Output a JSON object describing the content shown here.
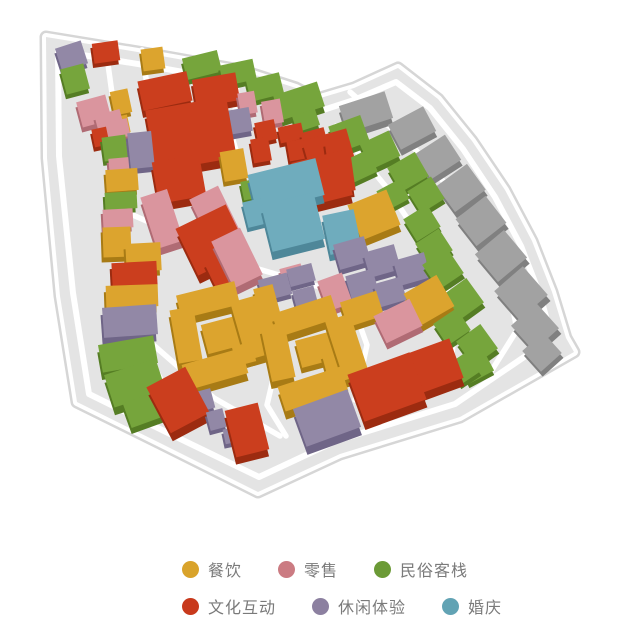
{
  "page": {
    "background": "#FFFFFF"
  },
  "categories": {
    "d": {
      "id": "dining",
      "label": "餐饮",
      "dot": "#D9A32B",
      "top": "#DCA42E",
      "side": "#A87B15"
    },
    "r": {
      "id": "retail",
      "label": "零售",
      "dot": "#CB7B82",
      "top": "#DA959E",
      "side": "#B06B74"
    },
    "i": {
      "id": "folk-inn",
      "label": "民俗客栈",
      "dot": "#6B9A36",
      "top": "#76A53C",
      "side": "#557D24"
    },
    "c": {
      "id": "culture",
      "label": "文化互动",
      "dot": "#C8391C",
      "top": "#CB3E1E",
      "side": "#9C2B10"
    },
    "l": {
      "id": "leisure",
      "label": "休闲体验",
      "dot": "#8C80A0",
      "top": "#9288A6",
      "side": "#6F6587"
    },
    "w": {
      "id": "wedding",
      "label": "婚庆",
      "dot": "#62A3B4",
      "top": "#6FACBD",
      "side": "#4E8799"
    },
    "g": {
      "id": "uncategorized",
      "label": "",
      "dot": "",
      "top": "#A2A2A2",
      "side": "#808080"
    }
  },
  "legend": {
    "text_color": "#7A7A7A",
    "rows": [
      {
        "items": [
          {
            "cat": "d",
            "label": "餐饮"
          },
          {
            "cat": "r",
            "label": "零售"
          },
          {
            "cat": "i",
            "label": "民俗客栈"
          }
        ]
      },
      {
        "items": [
          {
            "cat": "c",
            "label": "文化互动"
          },
          {
            "cat": "l",
            "label": "休闲体验"
          },
          {
            "cat": "w",
            "label": "婚庆"
          }
        ]
      }
    ]
  },
  "map": {
    "ground_color": "#E4E4E4",
    "border_color": "#D6D6D6",
    "road_color": "#FFFFFF",
    "outline": [
      [
        46,
        37
      ],
      [
        150,
        54
      ],
      [
        240,
        70
      ],
      [
        296,
        88
      ],
      [
        317,
        99
      ],
      [
        354,
        88
      ],
      [
        398,
        68
      ],
      [
        438,
        99
      ],
      [
        472,
        141
      ],
      [
        505,
        190
      ],
      [
        532,
        241
      ],
      [
        552,
        292
      ],
      [
        566,
        338
      ],
      [
        574,
        352
      ],
      [
        460,
        417
      ],
      [
        340,
        454
      ],
      [
        258,
        492
      ],
      [
        160,
        443
      ],
      [
        77,
        402
      ],
      [
        60,
        296
      ],
      [
        47,
        158
      ]
    ],
    "inner_loop": [
      [
        58,
        51
      ],
      [
        150,
        66
      ],
      [
        238,
        82
      ],
      [
        294,
        100
      ],
      [
        317,
        112
      ],
      [
        354,
        100
      ],
      [
        396,
        82
      ],
      [
        430,
        108
      ],
      [
        463,
        149
      ],
      [
        495,
        197
      ],
      [
        521,
        246
      ],
      [
        540,
        295
      ],
      [
        552,
        338
      ],
      [
        455,
        404
      ],
      [
        336,
        441
      ],
      [
        259,
        477
      ],
      [
        166,
        432
      ],
      [
        89,
        394
      ],
      [
        73,
        293
      ],
      [
        59,
        156
      ]
    ],
    "roads": [
      [
        [
          107,
          57
        ],
        [
          117,
          130
        ],
        [
          122,
          215
        ],
        [
          129,
          290
        ],
        [
          145,
          350
        ],
        [
          172,
          400
        ]
      ],
      [
        [
          142,
          50
        ],
        [
          149,
          100
        ]
      ],
      [
        [
          237,
          84
        ],
        [
          233,
          140
        ],
        [
          246,
          185
        ]
      ],
      [
        [
          126,
          212
        ],
        [
          190,
          240
        ],
        [
          255,
          268
        ],
        [
          330,
          290
        ],
        [
          400,
          308
        ],
        [
          448,
          323
        ]
      ],
      [
        [
          264,
          292
        ],
        [
          281,
          345
        ],
        [
          267,
          405
        ],
        [
          286,
          436
        ]
      ],
      [
        [
          150,
          342
        ],
        [
          214,
          398
        ],
        [
          280,
          436
        ]
      ],
      [
        [
          350,
          298
        ],
        [
          367,
          345
        ],
        [
          355,
          400
        ]
      ],
      [
        [
          350,
          92
        ],
        [
          414,
          148
        ],
        [
          467,
          208
        ],
        [
          505,
          268
        ],
        [
          517,
          330
        ],
        [
          492,
          370
        ]
      ],
      [
        [
          336,
          126
        ],
        [
          387,
          188
        ],
        [
          427,
          248
        ],
        [
          457,
          310
        ],
        [
          451,
          362
        ]
      ]
    ],
    "buildings": [
      [
        "l",
        58,
        44,
        27,
        24,
        -18
      ],
      [
        "c",
        93,
        42,
        26,
        20,
        -8
      ],
      [
        "d",
        142,
        48,
        22,
        22,
        -8
      ],
      [
        "i",
        63,
        66,
        24,
        26,
        -15
      ],
      [
        "r",
        79,
        98,
        30,
        26,
        -15
      ],
      [
        "r",
        97,
        112,
        26,
        24,
        -15
      ],
      [
        "d",
        112,
        90,
        18,
        24,
        -12
      ],
      [
        "c",
        93,
        128,
        15,
        18,
        -12
      ],
      [
        "d",
        113,
        116,
        16,
        18,
        -12
      ],
      [
        "r",
        99,
        121,
        30,
        18,
        -12
      ],
      [
        "i",
        103,
        136,
        24,
        24,
        -8
      ],
      [
        "l",
        129,
        132,
        24,
        36,
        -6
      ],
      [
        "r",
        109,
        158,
        20,
        16,
        -5
      ],
      [
        "d",
        106,
        169,
        32,
        22,
        -4
      ],
      [
        "i",
        105,
        192,
        32,
        17,
        -3
      ],
      [
        "r",
        103,
        209,
        30,
        19,
        -3
      ],
      [
        "d",
        103,
        227,
        28,
        30,
        -2
      ],
      [
        "d",
        126,
        243,
        35,
        28,
        -3
      ],
      [
        "c",
        112,
        262,
        45,
        24,
        -3
      ],
      [
        "d",
        106,
        285,
        52,
        22,
        -2
      ],
      [
        "l",
        103,
        306,
        54,
        30,
        -4
      ],
      [
        "i",
        100,
        340,
        56,
        28,
        -10
      ],
      [
        "i",
        108,
        366,
        54,
        34,
        -18
      ],
      [
        "i",
        126,
        396,
        40,
        26,
        -20
      ],
      [
        "c",
        156,
        374,
        44,
        52,
        -28
      ],
      [
        "l",
        196,
        390,
        17,
        20,
        -15
      ],
      [
        "l",
        208,
        410,
        17,
        19,
        -15
      ],
      [
        "c",
        230,
        406,
        34,
        48,
        -14
      ],
      [
        "l",
        224,
        428,
        14,
        15,
        -12
      ],
      [
        "c",
        140,
        76,
        50,
        30,
        -12
      ],
      [
        "c",
        194,
        76,
        44,
        28,
        -10
      ],
      [
        "i",
        184,
        54,
        36,
        22,
        -14
      ],
      [
        "i",
        221,
        62,
        34,
        21,
        -12
      ],
      [
        "i",
        248,
        76,
        34,
        22,
        -14
      ],
      [
        "i",
        276,
        88,
        46,
        26,
        -18
      ],
      [
        "i",
        294,
        112,
        24,
        17,
        -18
      ],
      [
        "c",
        150,
        103,
        82,
        62,
        -10
      ],
      [
        "l",
        215,
        110,
        36,
        24,
        -10
      ],
      [
        "r",
        239,
        92,
        17,
        22,
        -10
      ],
      [
        "r",
        263,
        100,
        19,
        24,
        -10
      ],
      [
        "l",
        229,
        112,
        22,
        20,
        -10
      ],
      [
        "c",
        256,
        121,
        20,
        20,
        -12
      ],
      [
        "c",
        279,
        125,
        24,
        16,
        -12
      ],
      [
        "c",
        302,
        130,
        24,
        16,
        -15
      ],
      [
        "c",
        252,
        138,
        18,
        24,
        -10
      ],
      [
        "c",
        288,
        140,
        18,
        20,
        -10
      ],
      [
        "c",
        306,
        134,
        46,
        36,
        -16
      ],
      [
        "d",
        222,
        150,
        24,
        30,
        -10
      ],
      [
        "c",
        155,
        158,
        48,
        42,
        -10
      ],
      [
        "r",
        148,
        192,
        28,
        54,
        -18
      ],
      [
        "r",
        199,
        190,
        32,
        52,
        -26
      ],
      [
        "r",
        221,
        232,
        32,
        52,
        -26
      ],
      [
        "c",
        184,
        214,
        56,
        52,
        -26
      ],
      [
        "c",
        208,
        252,
        38,
        30,
        -26
      ],
      [
        "i",
        242,
        180,
        17,
        19,
        -12
      ],
      [
        "w",
        251,
        166,
        70,
        38,
        -14
      ],
      [
        "w",
        266,
        198,
        54,
        48,
        -14
      ],
      [
        "w",
        245,
        200,
        19,
        26,
        -14
      ],
      [
        "c",
        296,
        156,
        52,
        46,
        -14
      ],
      [
        "c",
        328,
        138,
        24,
        54,
        -8
      ],
      [
        "d",
        353,
        196,
        42,
        38,
        -22
      ],
      [
        "w",
        326,
        212,
        32,
        40,
        -12
      ],
      [
        "l",
        336,
        240,
        32,
        26,
        -16
      ],
      [
        "l",
        366,
        248,
        32,
        26,
        -16
      ],
      [
        "l",
        396,
        256,
        32,
        26,
        -16
      ],
      [
        "l",
        348,
        272,
        28,
        24,
        -16
      ],
      [
        "l",
        376,
        280,
        28,
        24,
        -16
      ],
      [
        "i",
        332,
        120,
        34,
        28,
        -20
      ],
      [
        "i",
        364,
        136,
        32,
        28,
        -25
      ],
      [
        "i",
        348,
        154,
        26,
        24,
        -25
      ],
      [
        "i",
        392,
        158,
        32,
        28,
        -30
      ],
      [
        "i",
        380,
        184,
        26,
        22,
        -28
      ],
      [
        "i",
        412,
        182,
        28,
        26,
        -32
      ],
      [
        "i",
        408,
        210,
        28,
        26,
        -32
      ],
      [
        "i",
        420,
        234,
        28,
        26,
        -33
      ],
      [
        "i",
        428,
        254,
        30,
        30,
        -34
      ],
      [
        "i",
        448,
        284,
        30,
        30,
        -36
      ],
      [
        "i",
        438,
        314,
        28,
        26,
        -34
      ],
      [
        "i",
        462,
        330,
        30,
        30,
        -36
      ],
      [
        "i",
        452,
        356,
        24,
        24,
        -34
      ],
      [
        "g",
        342,
        98,
        48,
        28,
        -18
      ],
      [
        "g",
        392,
        114,
        40,
        28,
        -28
      ],
      [
        "g",
        420,
        142,
        36,
        30,
        -33
      ],
      [
        "g",
        442,
        172,
        38,
        32,
        -36
      ],
      [
        "g",
        462,
        204,
        38,
        34,
        -38
      ],
      [
        "g",
        482,
        238,
        38,
        36,
        -40
      ],
      [
        "g",
        502,
        274,
        38,
        38,
        -41
      ],
      [
        "g",
        518,
        310,
        34,
        34,
        -42
      ],
      [
        "g",
        528,
        338,
        28,
        28,
        -42
      ],
      [
        "d",
        178,
        288,
        60,
        24,
        -14
      ],
      [
        "d",
        174,
        308,
        24,
        54,
        -10
      ],
      [
        "d",
        184,
        356,
        62,
        26,
        -16
      ],
      [
        "d",
        238,
        298,
        26,
        60,
        -16
      ],
      [
        "d",
        204,
        320,
        36,
        30,
        -15
      ],
      [
        "d",
        234,
        344,
        20,
        20,
        -15
      ],
      [
        "d",
        258,
        286,
        20,
        40,
        -15
      ],
      [
        "d",
        274,
        304,
        62,
        24,
        -18
      ],
      [
        "d",
        266,
        324,
        24,
        56,
        -12
      ],
      [
        "d",
        280,
        376,
        66,
        26,
        -18
      ],
      [
        "d",
        334,
        316,
        26,
        62,
        -18
      ],
      [
        "d",
        298,
        336,
        34,
        28,
        -15
      ],
      [
        "d",
        324,
        352,
        20,
        20,
        -15
      ],
      [
        "d",
        343,
        296,
        38,
        26,
        -18
      ],
      [
        "d",
        410,
        282,
        38,
        36,
        -30
      ],
      [
        "r",
        322,
        276,
        26,
        32,
        -20
      ],
      [
        "r",
        281,
        266,
        22,
        16,
        -15
      ],
      [
        "r",
        378,
        306,
        40,
        30,
        -26
      ],
      [
        "l",
        260,
        276,
        30,
        22,
        -15
      ],
      [
        "l",
        288,
        266,
        26,
        18,
        -15
      ],
      [
        "l",
        294,
        288,
        22,
        18,
        -15
      ],
      [
        "c",
        354,
        362,
        66,
        50,
        -20
      ],
      [
        "c",
        406,
        346,
        52,
        42,
        -20
      ],
      [
        "l",
        298,
        398,
        58,
        40,
        -20
      ],
      [
        "i",
        464,
        362,
        28,
        16,
        -28
      ]
    ]
  }
}
